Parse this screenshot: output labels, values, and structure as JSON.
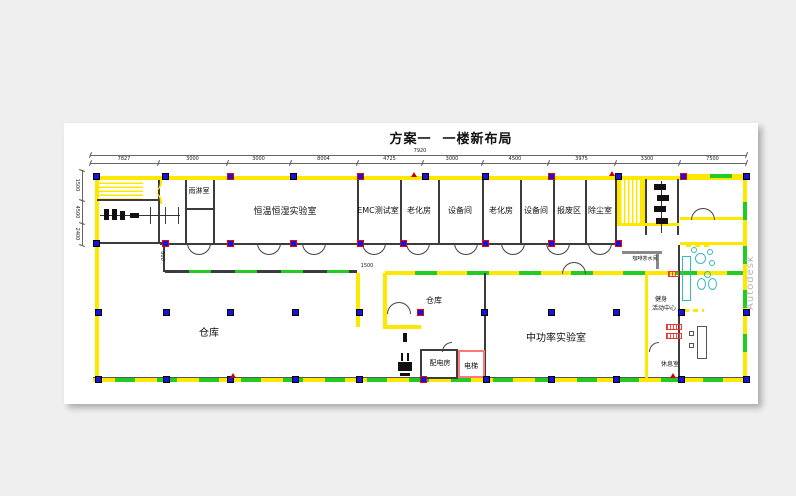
{
  "title": "方案一  一楼新布局",
  "watermark": "Autodesk",
  "rooms": {
    "rain": "雨淋室",
    "const_temp_hum_lab": "恒温恒湿实验室",
    "emc_test": "EMC测试室",
    "aging_1": "老化房",
    "equip_1": "设备间",
    "aging_2": "老化房",
    "equip_2": "设备间",
    "scrap": "报废区",
    "dust": "除尘室",
    "warehouse_large": "仓库",
    "warehouse_small": "仓库",
    "mid_power_lab": "中功率实验室",
    "power_room": "配电房",
    "elevator": "电梯",
    "tea_room": "咖啡茶水间",
    "fitness_l1": "健身",
    "fitness_l2": "活动中心",
    "lounge": "休息室"
  },
  "dimensions": {
    "overall": "7920",
    "top_segments": [
      "7827",
      "3000",
      "3000",
      "8004",
      "4725",
      "3000",
      "4500",
      "3975",
      "3300",
      "7500"
    ],
    "left_segments": [
      "1500",
      "4500",
      "2400"
    ],
    "corridor": "800",
    "passage": "1500"
  }
}
